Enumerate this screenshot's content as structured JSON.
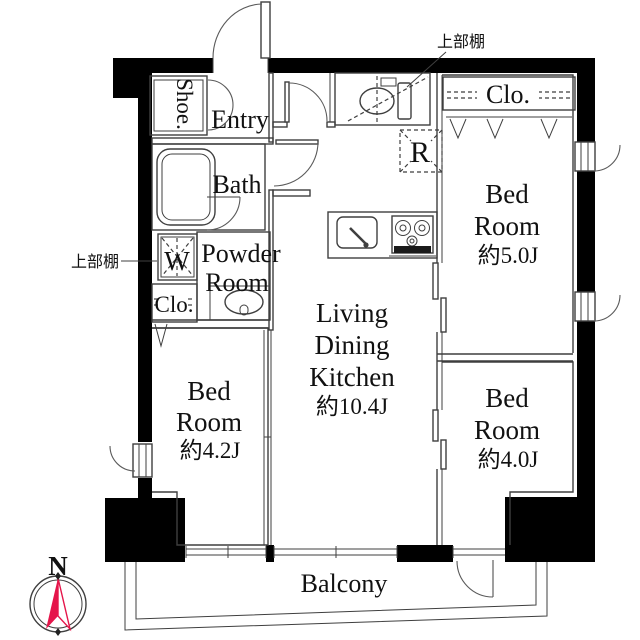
{
  "colors": {
    "compass_red": "#e5154a",
    "wall_black": "#000000",
    "line_gray": "#3f3f3f"
  },
  "annotations": {
    "upper_shelf_top": "上部棚",
    "upper_shelf_left": "上部棚"
  },
  "entry_area": {
    "shoe_cabinet": "Shoe.",
    "entry": "Entry"
  },
  "sanitary": {
    "bath": "Bath",
    "powder_room_line1": "Powder",
    "powder_room_line2": "Room",
    "washer": "W",
    "closet": "Clo."
  },
  "kitchen": {
    "fridge": "R"
  },
  "living_dining_kitchen": {
    "line1": "Living",
    "line2": "Dining",
    "line3": "Kitchen",
    "area": "約10.4J"
  },
  "bedroom_ne": {
    "closet": "Clo.",
    "line1": "Bed",
    "line2": "Room",
    "area": "約5.0J"
  },
  "bedroom_se": {
    "line1": "Bed",
    "line2": "Room",
    "area": "約4.0J"
  },
  "bedroom_sw": {
    "line1": "Bed",
    "line2": "Room",
    "area": "約4.2J"
  },
  "balcony": {
    "label": "Balcony"
  },
  "compass": {
    "north": "N"
  }
}
